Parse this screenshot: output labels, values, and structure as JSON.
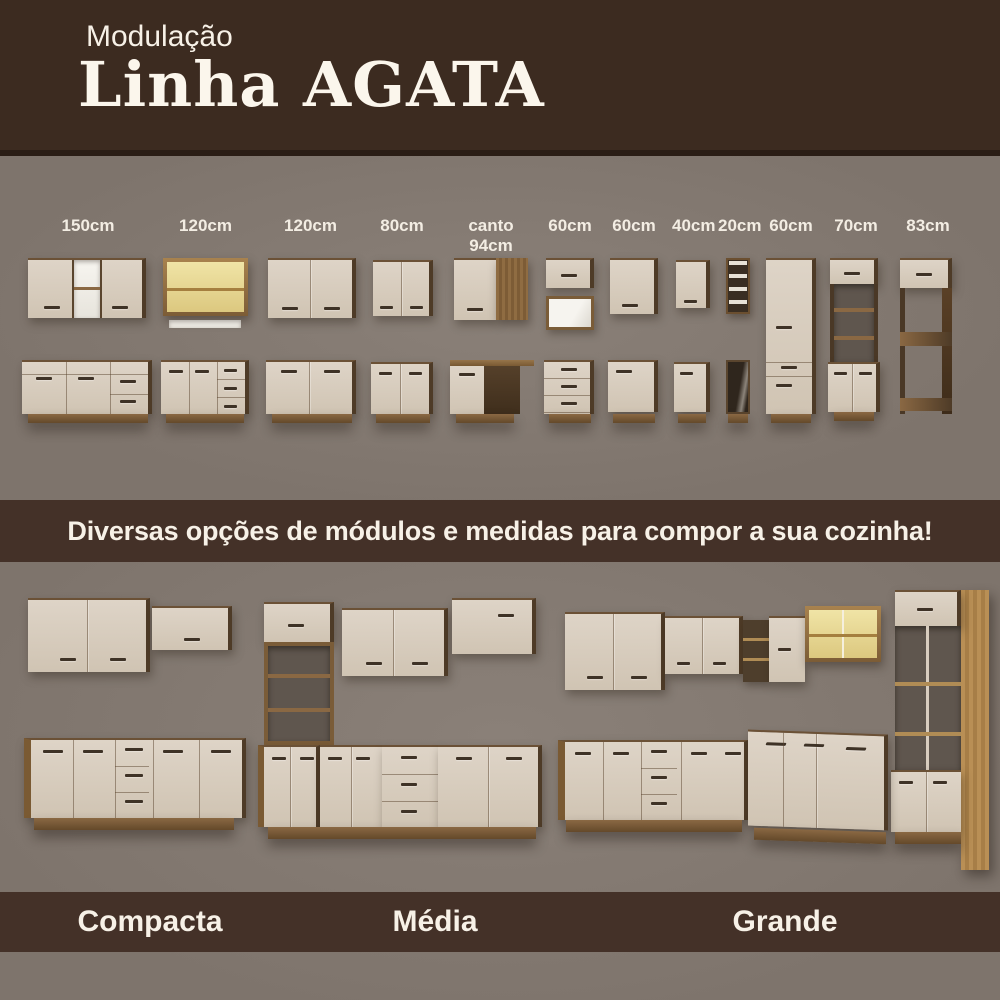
{
  "header": {
    "subtitle": "Modulação",
    "title": "Linha AGATA"
  },
  "modules": {
    "items": [
      {
        "size": "150cm"
      },
      {
        "size": "120cm"
      },
      {
        "size": "120cm"
      },
      {
        "size": "80cm"
      },
      {
        "size": "canto 94cm"
      },
      {
        "size": "60cm"
      },
      {
        "size": "60cm"
      },
      {
        "size": "40cm"
      },
      {
        "size": "20cm"
      },
      {
        "size": "60cm"
      },
      {
        "size": "70cm"
      },
      {
        "size": "83cm"
      }
    ]
  },
  "banner": {
    "text": "Diversas opções de módulos e medidas para compor a sua cozinha!"
  },
  "kitchens": {
    "items": [
      {
        "label": "Compacta"
      },
      {
        "label": "Média"
      },
      {
        "label": "Grande"
      }
    ]
  },
  "colors": {
    "brown-header": "#3c2b20",
    "brown-band": "#443128",
    "bg-gray": "#7e746c",
    "bg-gray-light": "#8a8078",
    "cream": "#d8cdbf",
    "wood": "#8a6843",
    "wood-dark": "#4e3b27",
    "wood-gold": "#b08c55",
    "glass-lit": "#e9da96",
    "text-light": "#f7f1e7"
  }
}
